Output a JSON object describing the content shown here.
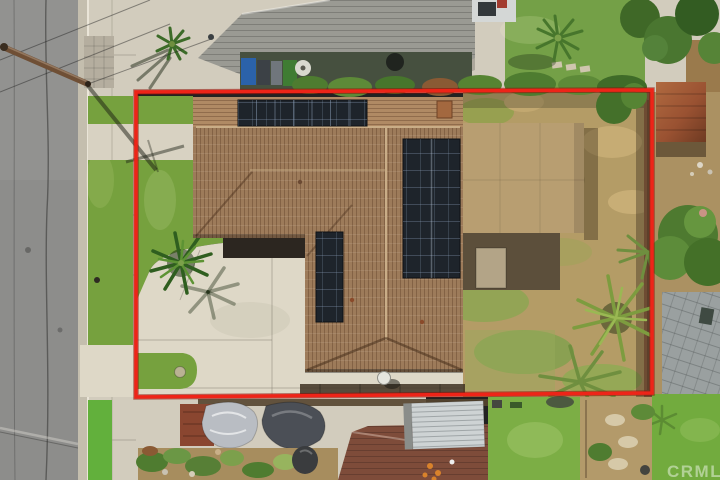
{
  "watermark": {
    "label": "CRMLS"
  },
  "colors": {
    "boundary_red": "#ee2418",
    "asphalt": "#8d8d8b",
    "concrete": "#d2ccbd",
    "driveway": "#ded8c7",
    "lawn_green": "#76a13e",
    "turf_green": "#62b03c",
    "dry_grass": "#b49c66",
    "roof_tile": "#9d7b5a",
    "roof_tile_light": "#b08a64",
    "solar_panel": "#1e242b",
    "patio_tan": "#b89e71",
    "neighbor_roof_gray": "#9a9a93",
    "neighbor_roof_brown": "#7e4c3a",
    "carport_white": "#ced3d4",
    "shed_rust": "#9a5a36",
    "fence_wood": "#6e4c33",
    "paver_gray": "#9aa0a0",
    "watermark_white": "rgba(255,255,255,0.45)"
  }
}
